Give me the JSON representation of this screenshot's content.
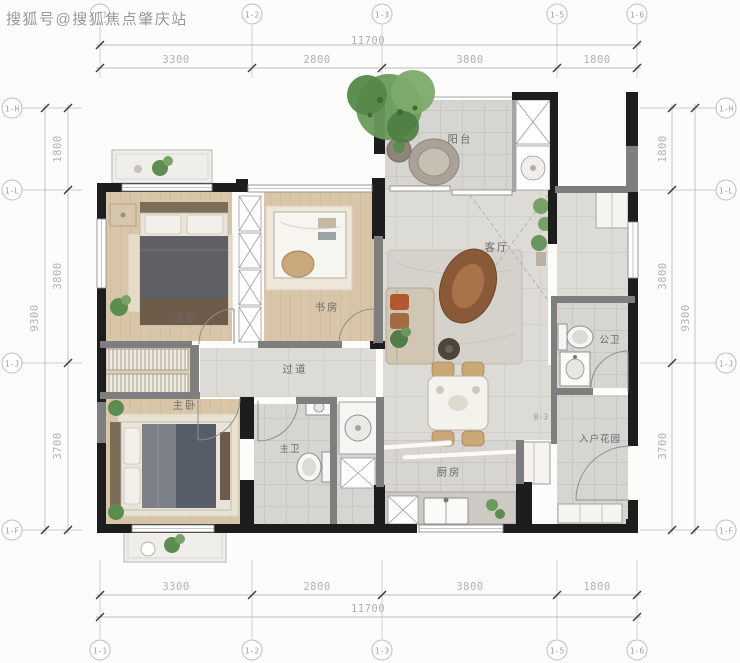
{
  "watermark": {
    "text": "搜狐号@搜狐焦点肇庆站"
  },
  "unit": {
    "label": "B-3"
  },
  "colors": {
    "wall": "#1d1d1d",
    "partition_wall": "#7e7e7e",
    "wood_floor": "#d9c6a9",
    "marble_floor": "#dcdbd6",
    "tile_floor": "#d6d5d1",
    "dimension_text": "#b2b2b2",
    "plant_green": "#6a9a5b",
    "pillow_orange": "#b2582e"
  },
  "grid": {
    "top": [
      {
        "label": "1-1"
      },
      {
        "label": "1-2"
      },
      {
        "label": "1-3"
      },
      {
        "label": "1-5"
      },
      {
        "label": "1-6"
      }
    ],
    "bottom": [
      {
        "label": "1-1"
      },
      {
        "label": "1-2"
      },
      {
        "label": "1-3"
      },
      {
        "label": "1-5"
      },
      {
        "label": "1-6"
      }
    ],
    "left": [
      {
        "label": "1-H"
      },
      {
        "label": "1-L"
      },
      {
        "label": "1-J"
      },
      {
        "label": "1-F"
      }
    ],
    "right": [
      {
        "label": "1-H"
      },
      {
        "label": "1-L"
      },
      {
        "label": "1-J"
      },
      {
        "label": "1-F"
      }
    ]
  },
  "dimensions": {
    "top": {
      "total": "11700",
      "segments": [
        "3300",
        "2800",
        "3800",
        "1800"
      ]
    },
    "bottom": {
      "total": "11700",
      "segments": [
        "3300",
        "2800",
        "3800",
        "1800"
      ]
    },
    "left": {
      "total": "9300",
      "segments": [
        "1800",
        "3800",
        "3700"
      ]
    },
    "right": {
      "total": "9300",
      "segments": [
        "1800",
        "3800",
        "3700"
      ]
    }
  },
  "rooms": {
    "balcony": {
      "label": "阳台"
    },
    "living": {
      "label": "客厅"
    },
    "secondary_bedroom": {
      "label": "次卧"
    },
    "study": {
      "label": "书房"
    },
    "corridor": {
      "label": "过道"
    },
    "master_bedroom": {
      "label": "主卧"
    },
    "master_bathroom": {
      "label": "主卫"
    },
    "kitchen": {
      "label": "厨房"
    },
    "public_bathroom": {
      "label": "公卫"
    },
    "entry_garden": {
      "label": "入户花园"
    }
  }
}
